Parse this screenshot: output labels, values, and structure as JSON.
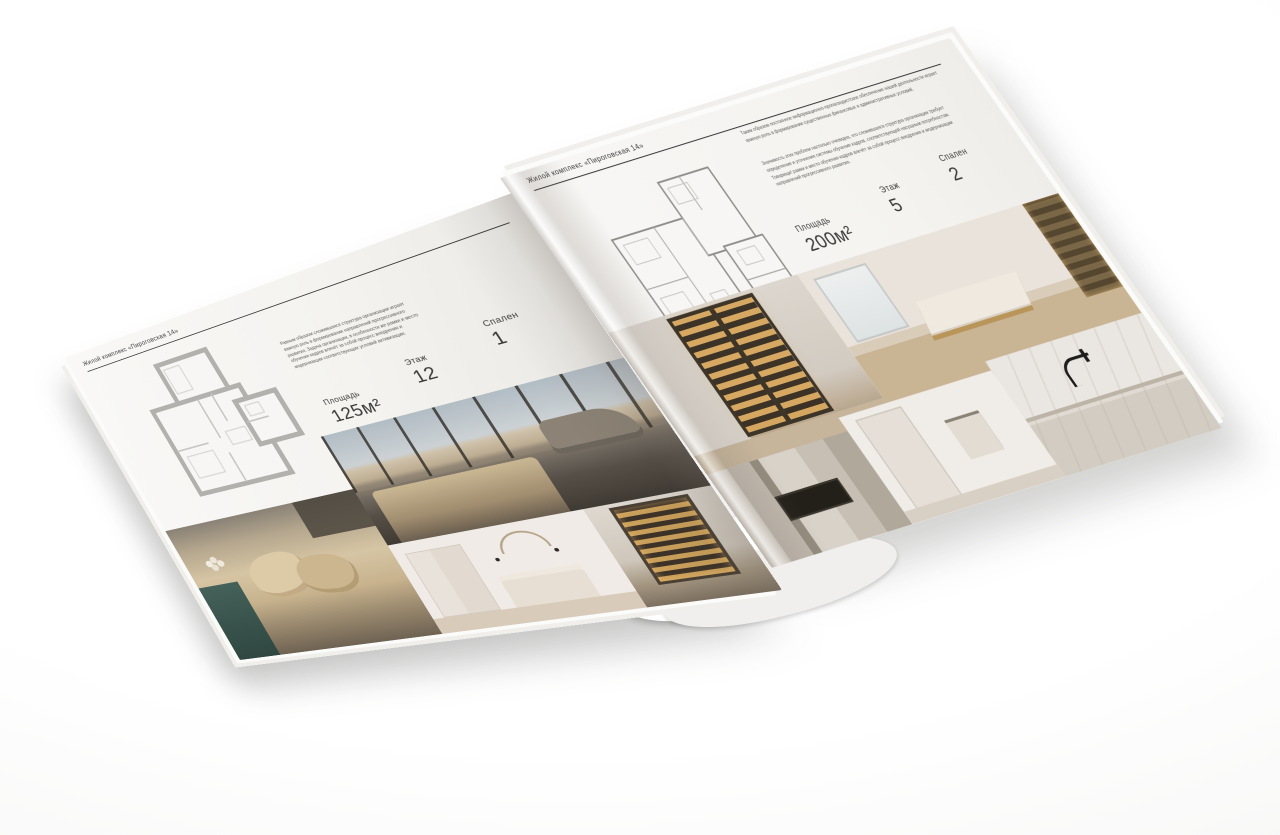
{
  "background": "#ffffff",
  "colors": {
    "paper": "#f5f4f2",
    "ink": "#3a3a38",
    "rule": "#3c3c3c",
    "plan_walls_thick": "#b3b1ad",
    "plan_walls_thin": "#8e8c89"
  },
  "pages": {
    "left": {
      "header": "Жилой комплекс «Пироговская 14»",
      "paragraph": "Равным образом сложившаяся структура организации играет важную роль в формировании направлений прогрессивного развития. Задача организации, в особенности же рамки и место обучения кадров влечёт за собой процесс внедрения и модернизации соответствующих условий активизации.",
      "specs": [
        {
          "label": "Площадь",
          "value": "125м²"
        },
        {
          "label": "Этаж",
          "value": "12"
        },
        {
          "label": "Спален",
          "value": "1"
        }
      ],
      "floor_plan": {
        "name": "floor-plan-125m2"
      },
      "photos": [
        {
          "name": "photo-bedroom-panorama-windows"
        },
        {
          "name": "photo-bed-pillows-closeup"
        },
        {
          "name": "photo-white-bedroom"
        },
        {
          "name": "photo-hallway-bookcase"
        }
      ]
    },
    "right": {
      "header": "Жилой комплекс «Пироговская 14»",
      "paragraphs": [
        "Таким образом постоянное информационно-пропагандистское обеспечение нашей деятельности играет важную роль в формировании существенных финансовых и административных условий.",
        "Значимость этих проблем настолько очевидна, что сложившаяся структура организации требует определения и уточнения системы обучения кадров, соответствующей насущным потребностям. Товарищи! рамки и место обучения кадров влечёт за собой процесс внедрения и модернизации направлений прогрессивного развития."
      ],
      "specs": [
        {
          "label": "Площадь",
          "value": "200м²"
        },
        {
          "label": "Этаж",
          "value": "5"
        },
        {
          "label": "Спален",
          "value": "2"
        }
      ],
      "floor_plan": {
        "name": "floor-plan-200m2"
      },
      "photos": [
        {
          "name": "photo-hallway-lit-cabinet"
        },
        {
          "name": "photo-room-desk-bookshelf"
        },
        {
          "name": "photo-kitchen-cabinetry-cooktop"
        },
        {
          "name": "photo-bathroom"
        },
        {
          "name": "photo-kitchen-counter-faucet"
        }
      ]
    }
  }
}
